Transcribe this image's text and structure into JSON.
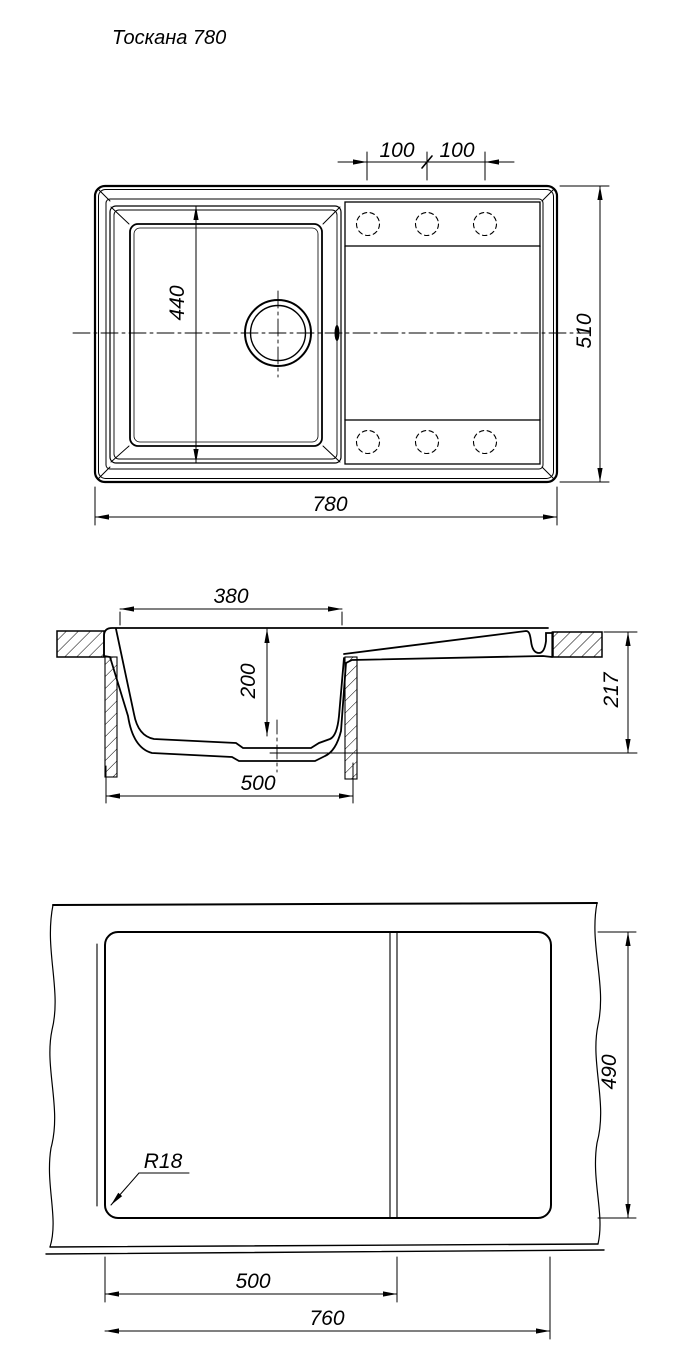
{
  "drawing_title": "Тоскана 780",
  "top_view": {
    "dim_tap_hole_spacing_left": "100",
    "dim_tap_hole_spacing_right": "100",
    "dim_bowl_length": "440",
    "dim_overall_width": "510",
    "dim_overall_length": "780"
  },
  "section_view": {
    "dim_bowl_top_width": "380",
    "dim_bowl_depth": "200",
    "dim_base_width": "500",
    "dim_overall_height": "217"
  },
  "cutout_view": {
    "dim_cutout_depth": "490",
    "dim_corner_radius": "R18",
    "dim_bowl_section_width": "500",
    "dim_cutout_width": "760"
  }
}
